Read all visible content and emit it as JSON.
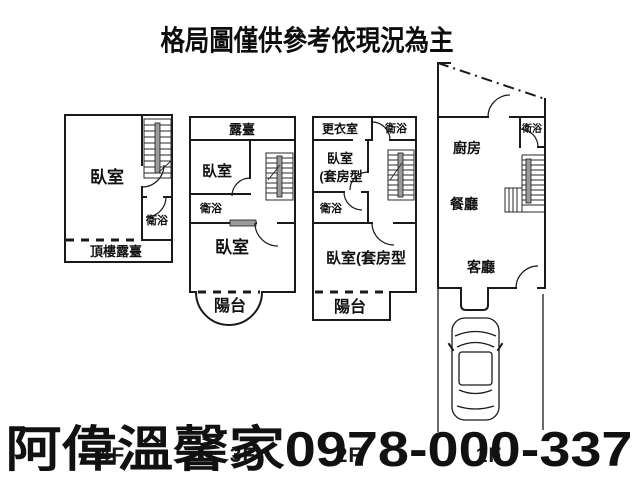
{
  "title": "格局圖僅供參考依現況為主",
  "watermark": {
    "text": "阿偉溫馨家0978-000-337",
    "color": "#1f35c8"
  },
  "floors": [
    {
      "label": "4F",
      "rooms": {
        "bedroom": "臥室",
        "bathroom": "衛浴",
        "roof_terrace": "頂樓露臺"
      }
    },
    {
      "label": "3F",
      "rooms": {
        "terrace": "露臺",
        "bedroom_upper": "臥室",
        "bathroom": "衛浴",
        "bedroom_lower": "臥室",
        "balcony": "陽台"
      }
    },
    {
      "label": "2F",
      "rooms": {
        "walk_in_closet": "更衣室",
        "bathroom_top": "衛浴",
        "bedroom_suite_line1": "臥室",
        "bedroom_suite_line2": "(套房型",
        "bathroom_mid": "衛浴",
        "bedroom_suite_main": "臥室(套房型",
        "balcony": "陽台"
      }
    },
    {
      "label": "1F",
      "rooms": {
        "kitchen": "廚房",
        "bathroom": "衛浴",
        "dining_room": "餐廳",
        "living_room": "客廳"
      }
    }
  ]
}
